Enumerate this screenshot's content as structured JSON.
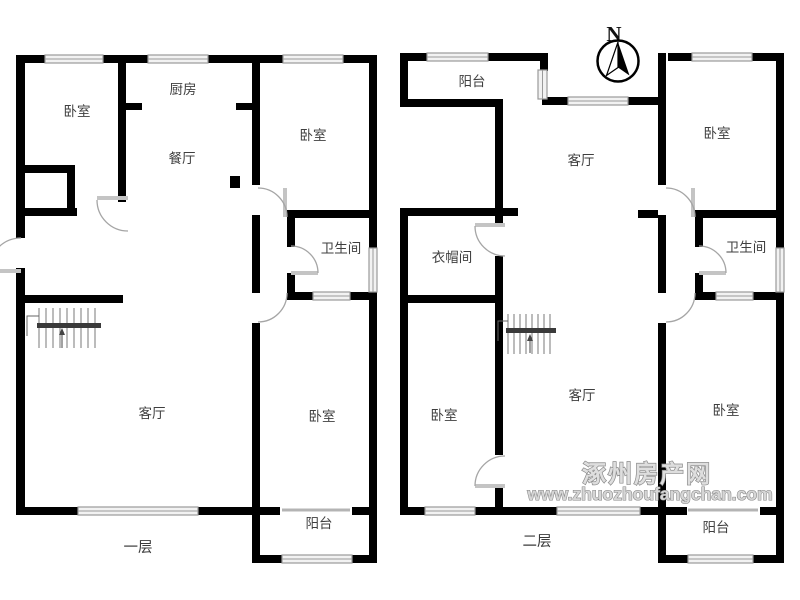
{
  "north_indicator": {
    "label": "N"
  },
  "watermark": {
    "line1": "涿州房产网",
    "line2": "www.zhuozhoufangchan.com"
  },
  "floor1": {
    "floor_label": "一层",
    "rooms": {
      "bedroom_top_left": "卧室",
      "kitchen": "厨房",
      "dining_room": "餐厅",
      "bedroom_top_right": "卧室",
      "bathroom": "卫生间",
      "living_room": "客厅",
      "bedroom_bottom_right": "卧室",
      "balcony": "阳台"
    }
  },
  "floor2": {
    "floor_label": "二层",
    "rooms": {
      "balcony_top": "阳台",
      "living_room_upper": "客厅",
      "bedroom_top_right": "卧室",
      "cloakroom": "衣帽间",
      "bathroom": "卫生间",
      "living_room_lower": "客厅",
      "bedroom_bottom_left": "卧室",
      "bedroom_bottom_right": "卧室",
      "balcony_bottom": "阳台"
    }
  },
  "colors": {
    "wall": "#000000",
    "window_outline": "#9a9a9a",
    "door_arc": "#a5a5a5",
    "stair_line": "#787878",
    "label_text": "#3f3f3f",
    "watermark_fill": "#dedede",
    "watermark_outline": "#8a8a8a"
  }
}
